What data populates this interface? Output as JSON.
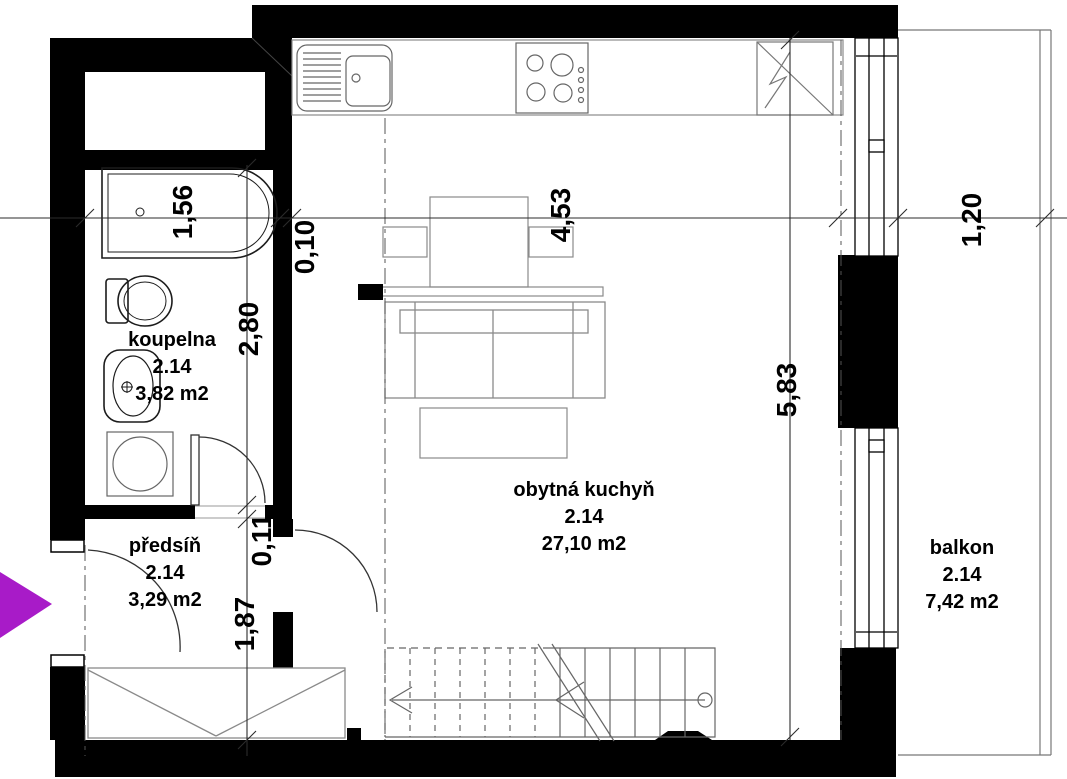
{
  "rooms": {
    "koupelna": {
      "name": "koupelna",
      "number": "2.14",
      "area": "3,82 m2"
    },
    "predsin": {
      "name": "předsíň",
      "number": "2.14",
      "area": "3,29 m2"
    },
    "obytna_kuchyn": {
      "name": "obytná kuchyň",
      "number": "2.14",
      "area": "27,10 m2"
    },
    "balkon": {
      "name": "balkon",
      "number": "2.14",
      "area": "7,42 m2"
    }
  },
  "dimensions": {
    "horizontal": [
      "1,56",
      "0,10",
      "4,53",
      "1,20"
    ],
    "vertical": [
      "2,80",
      "0,11",
      "1,87",
      "5,83"
    ]
  },
  "fixtures": [
    "bathtub",
    "toilet",
    "washbasin",
    "washing-machine",
    "kitchen-sink",
    "hob",
    "fridge",
    "dining-table",
    "chairs",
    "sofa",
    "coffee-table",
    "sideboard",
    "wardrobe",
    "staircase",
    "balcony"
  ],
  "colors": {
    "wall": "#000000",
    "entrance_arrow": "#A81BC8",
    "linework_light": "#8a8a8a",
    "background": "#ffffff"
  }
}
